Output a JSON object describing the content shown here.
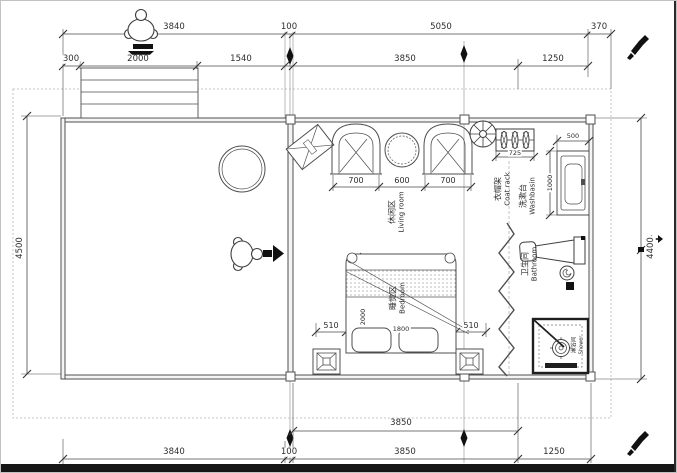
{
  "drawing": {
    "kind": "floor-plan"
  },
  "dims": {
    "top_row1": [
      "3840",
      "100",
      "5050",
      "370"
    ],
    "top_row2": [
      "300",
      "2000",
      "1540",
      "3850",
      "1250"
    ],
    "left": "4500",
    "right": "4400",
    "bottom_row1": "3850",
    "bottom_row2": [
      "3840",
      "100",
      "3850",
      "1250"
    ],
    "living_row": [
      "700",
      "600",
      "700"
    ],
    "bed_row": [
      "510",
      "1800",
      "510"
    ],
    "bed_length": "2000",
    "washbasin_width": "500",
    "washbasin_length": "1000",
    "coat_rack_width": "725"
  },
  "rooms": {
    "living": {
      "zh": "休闲区",
      "en": "Living room"
    },
    "bedroom": {
      "zh": "睡觉区",
      "en": "Bedroom"
    },
    "coat_rack": {
      "zh": "衣帽架",
      "en": "Coat rack"
    },
    "washbasin": {
      "zh": "洗漱台",
      "en": "Washbasin"
    },
    "bathroom": {
      "zh": "卫生间",
      "en": "Bathroom"
    },
    "shower": {
      "zh": "淋浴间",
      "en": "Shower"
    }
  },
  "icons": [
    "person-top-view",
    "down-arrow",
    "right-arrow",
    "ceiling-fan",
    "pen",
    "left-right-arrow"
  ],
  "colors": {
    "line": "#4f4f4f",
    "dash": "#b5b5b5",
    "ink": "#111111",
    "background": "#ffffff"
  }
}
